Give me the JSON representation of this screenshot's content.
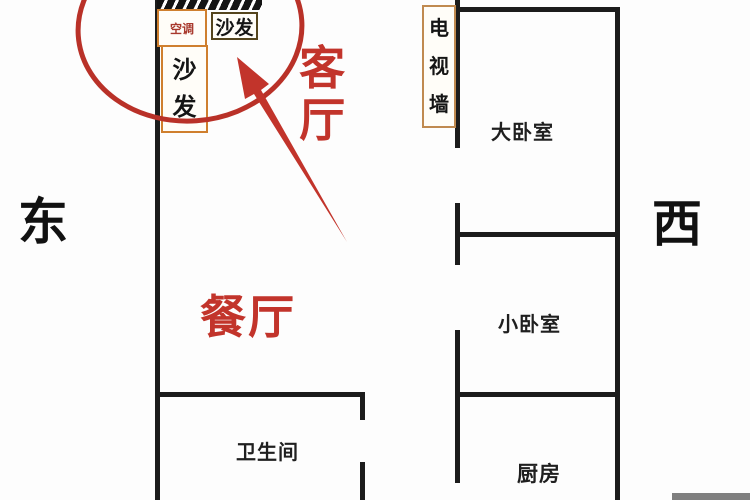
{
  "compass": {
    "east": "东",
    "west": "西"
  },
  "rooms": {
    "living": "客厅",
    "dining": "餐厅",
    "big_bedroom": "大卧室",
    "small_bedroom": "小卧室",
    "kitchen": "厨房",
    "bathroom": "卫生间"
  },
  "furniture": {
    "ac": "空调",
    "sofa_top": "沙发",
    "sofa_side": "沙发",
    "tv_wall": "电视墙"
  },
  "colors": {
    "wall": "#1c1c1c",
    "furniture_border_orange": "#cf7f2e",
    "furniture_border_tan": "#c08a50",
    "annotation_red": "#c2342b",
    "ac_text_red": "#a8382c",
    "footer_bar_gray": "#7f7f7f"
  }
}
